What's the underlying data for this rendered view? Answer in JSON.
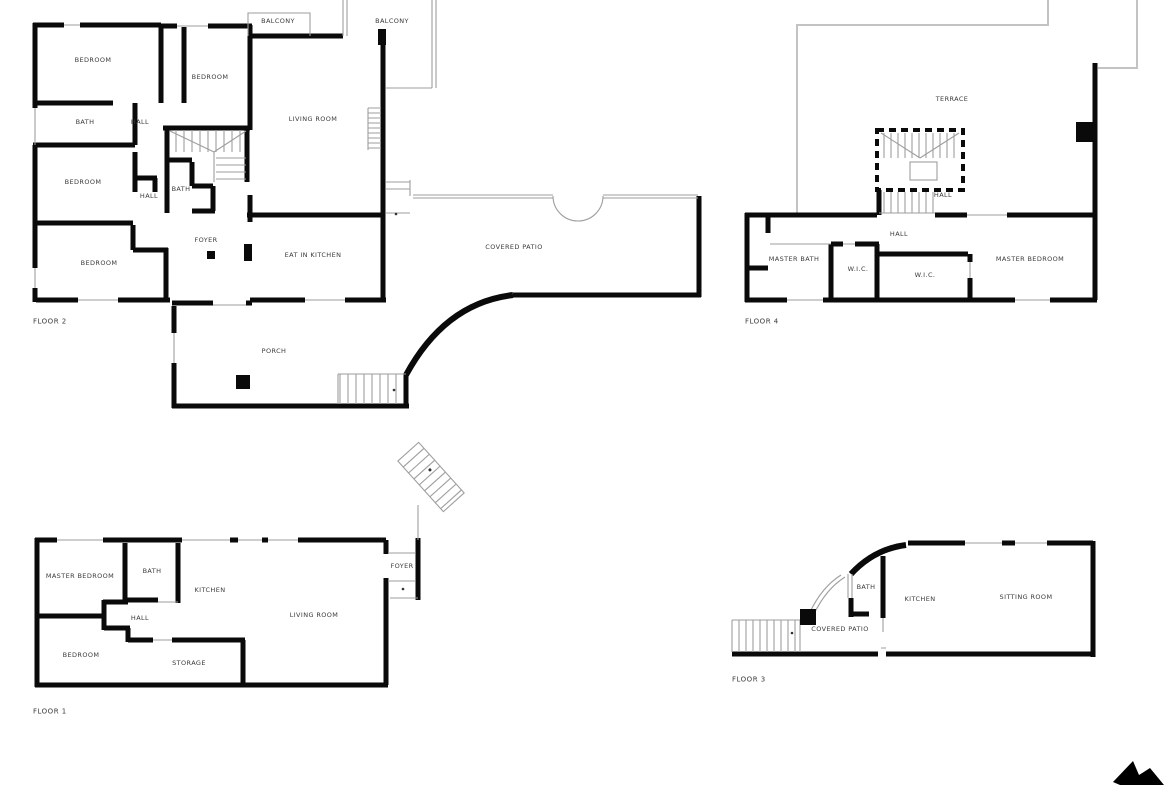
{
  "canvas": {
    "width": 1170,
    "height": 785,
    "background": "#ffffff"
  },
  "colors": {
    "wall": "#0a0a0a",
    "thin_line": "#9e9e9e",
    "light_outline": "#c3c3c3",
    "label_text": "#3a3a3a"
  },
  "floor2": {
    "title": "FLOOR 2",
    "labels": {
      "balcony_left": "BALCONY",
      "balcony_right": "BALCONY",
      "bedroom_top_left": "BEDROOM",
      "bedroom_top_mid": "BEDROOM",
      "living_room": "LIVING ROOM",
      "bath_upper": "BATH",
      "hall_upper": "HALL",
      "bedroom_mid": "BEDROOM",
      "hall_lower": "HALL",
      "bath_lower": "BATH",
      "foyer": "FOYER",
      "bedroom_bottom": "BEDROOM",
      "eat_in_kitchen": "EAT IN KITCHEN",
      "covered_patio": "COVERED PATIO",
      "porch": "PORCH"
    }
  },
  "floor4": {
    "title": "FLOOR 4",
    "labels": {
      "terrace": "TERRACE",
      "hall_upper": "HALL",
      "hall": "HALL",
      "master_bath": "MASTER BATH",
      "wic_1": "W.I.C.",
      "wic_2": "W.I.C.",
      "master_bedroom": "MASTER BEDROOM"
    }
  },
  "floor1": {
    "title": "FLOOR 1",
    "labels": {
      "master_bedroom": "MASTER BEDROOM",
      "bath": "BATH",
      "kitchen": "KITCHEN",
      "hall": "HALL",
      "living_room": "LIVING ROOM",
      "bedroom": "BEDROOM",
      "storage": "STORAGE",
      "foyer": "FOYER"
    }
  },
  "floor3": {
    "title": "FLOOR 3",
    "labels": {
      "bath": "BATH",
      "kitchen": "KITCHEN",
      "sitting_room": "SITTING ROOM",
      "covered_patio": "COVERED PATIO"
    }
  },
  "cursor": {
    "icon": "cursor-arrow"
  }
}
